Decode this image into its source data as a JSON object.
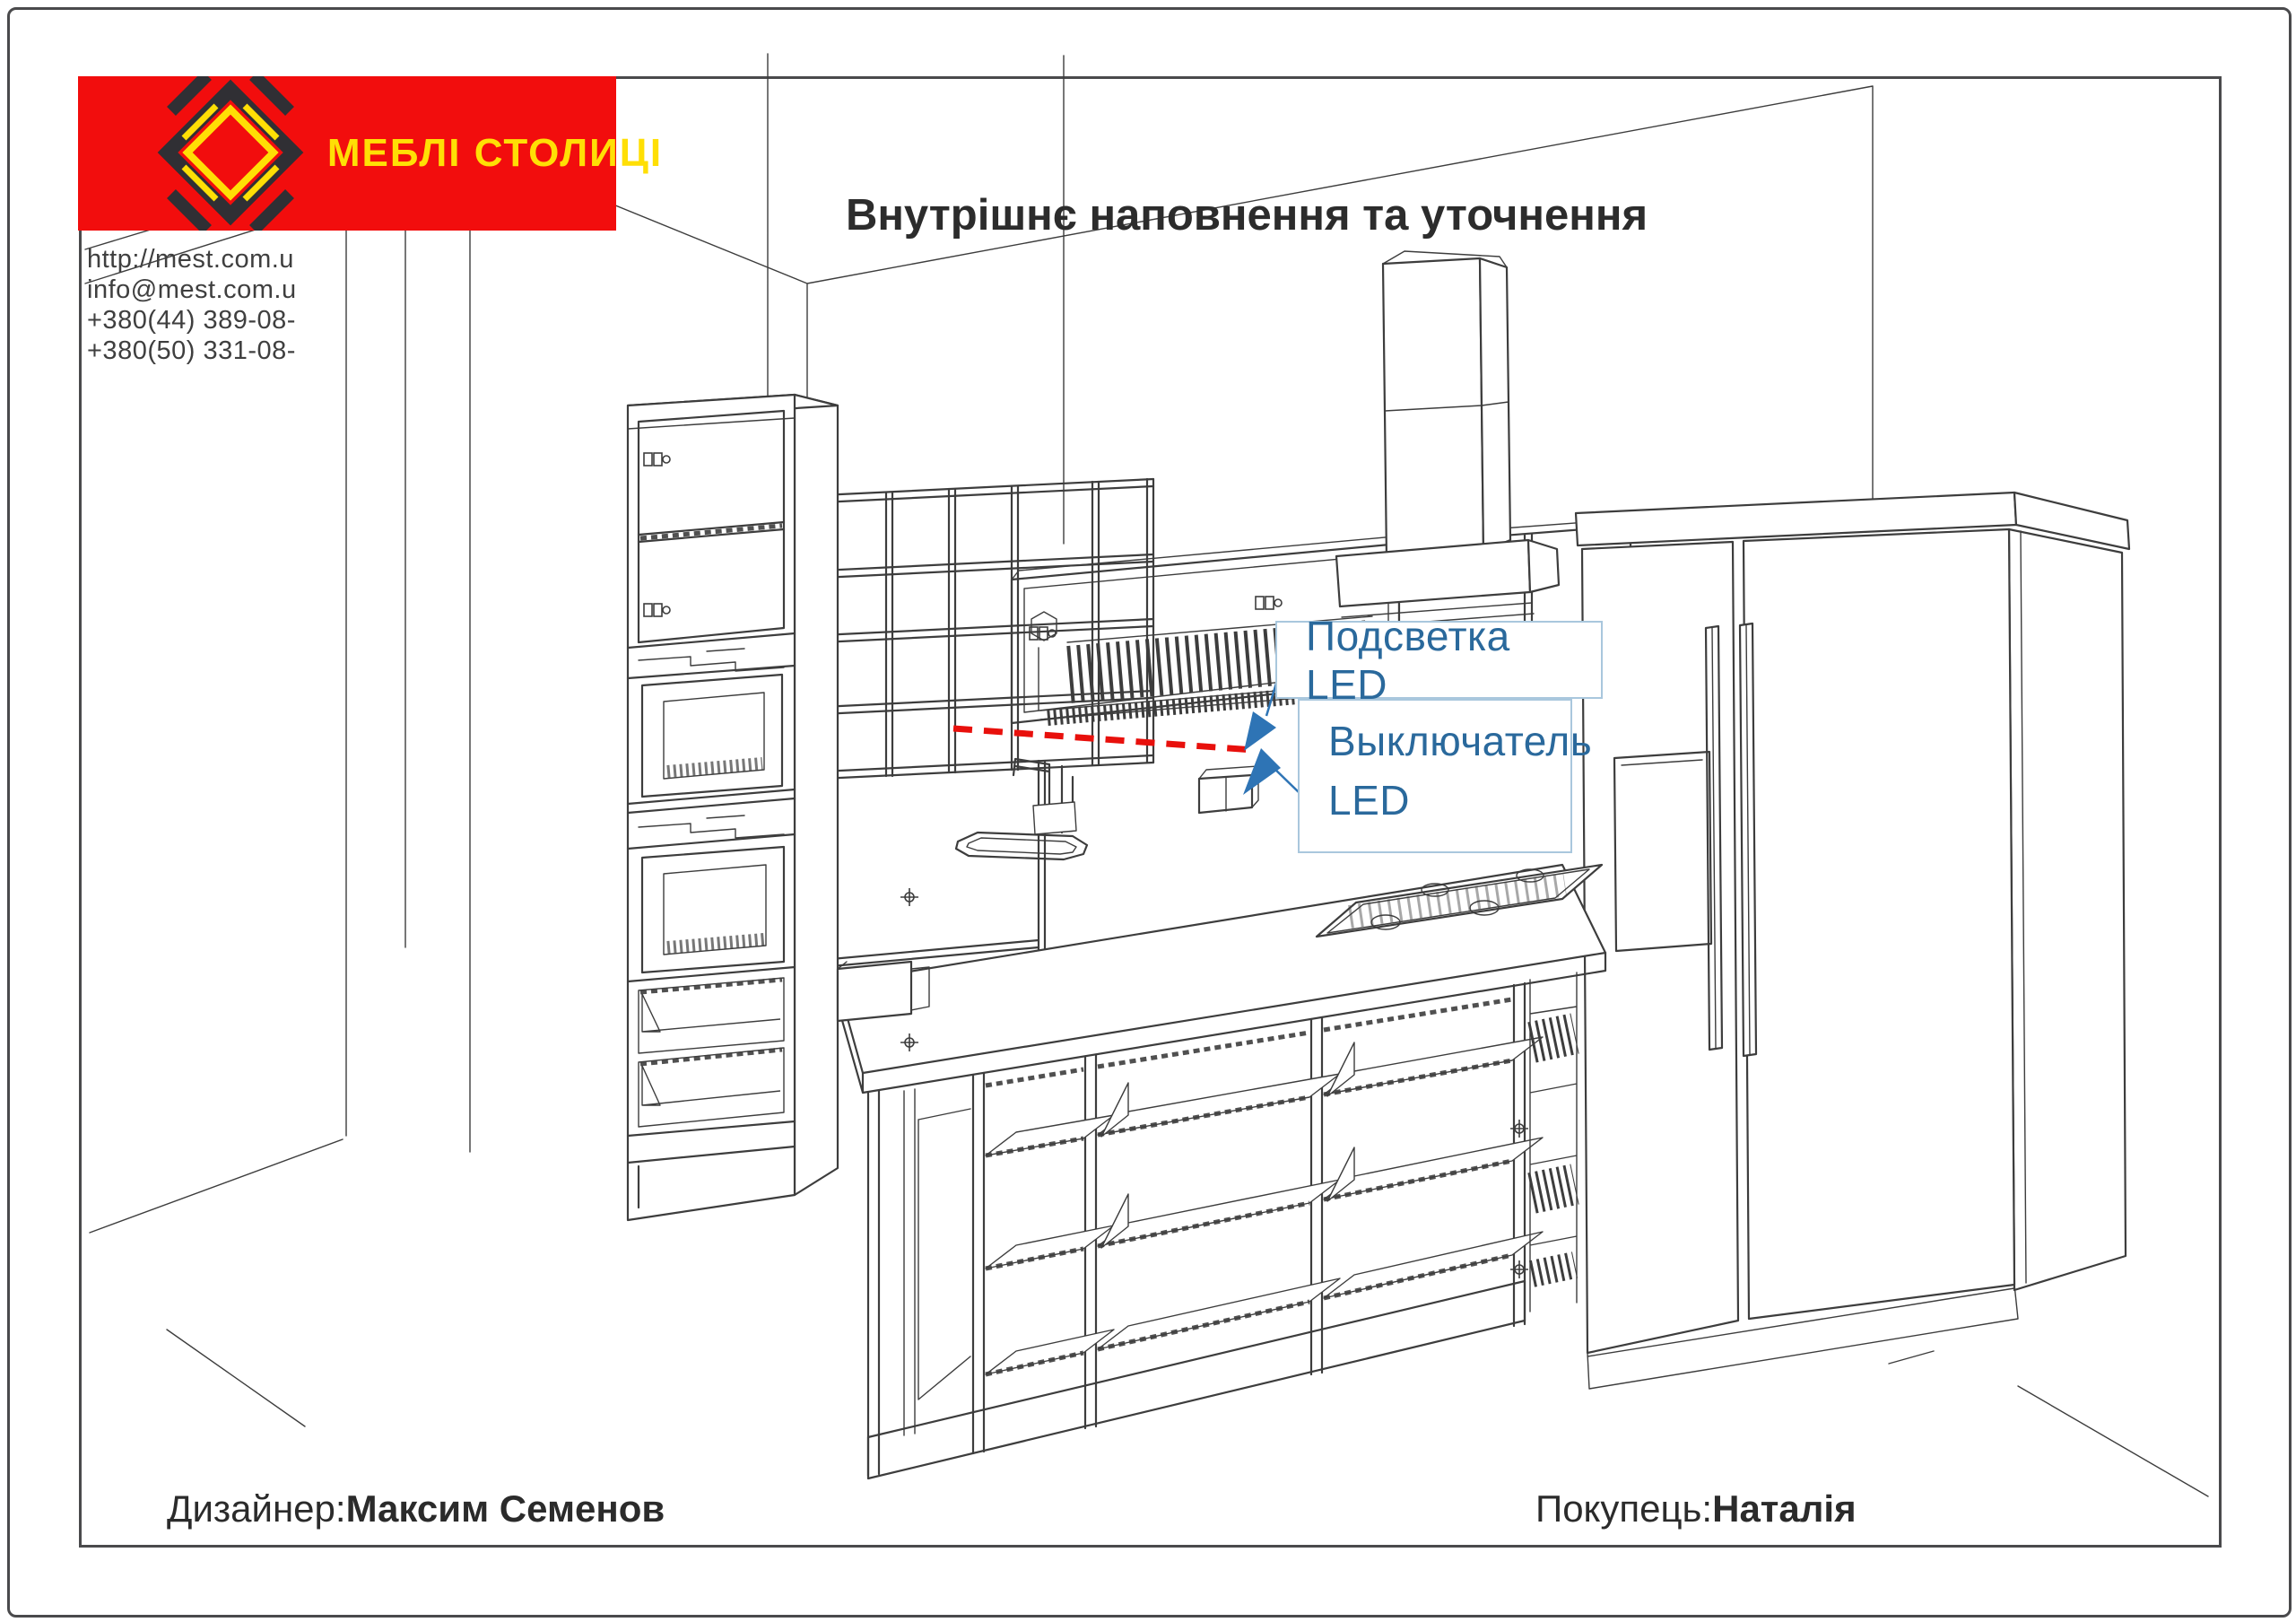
{
  "theme": {
    "brand_red": "#F20D0D",
    "brand_yellow": "#FFDF05",
    "logo_dark": "#302F34",
    "line": "#3D3D3D",
    "ink": "#2B2B2B",
    "paper": "#FFFFFF",
    "callout_text": "#2A699C",
    "callout_border": "#A9C7DD",
    "arrow_blue": "#2E74B5",
    "led_red": "#E8100C"
  },
  "logo": {
    "brand": "МЕБЛІ СТОЛИЦІ"
  },
  "contact": {
    "lines": [
      "http://mest.com.u",
      "info@mest.com.u",
      "+380(44)  389-08-",
      "+380(50)  331-08-"
    ]
  },
  "header": {
    "title": "Внутрішнє наповнення та уточнення"
  },
  "callouts": {
    "backlight": "Подсветка LED",
    "switch_line1": "Выключатель",
    "switch_line2": "LED"
  },
  "footer": {
    "designer_label": "Дизайнер:",
    "designer_name": "Максим Семенов",
    "buyer_label": "Покупець:",
    "buyer_name": "Наталія"
  }
}
